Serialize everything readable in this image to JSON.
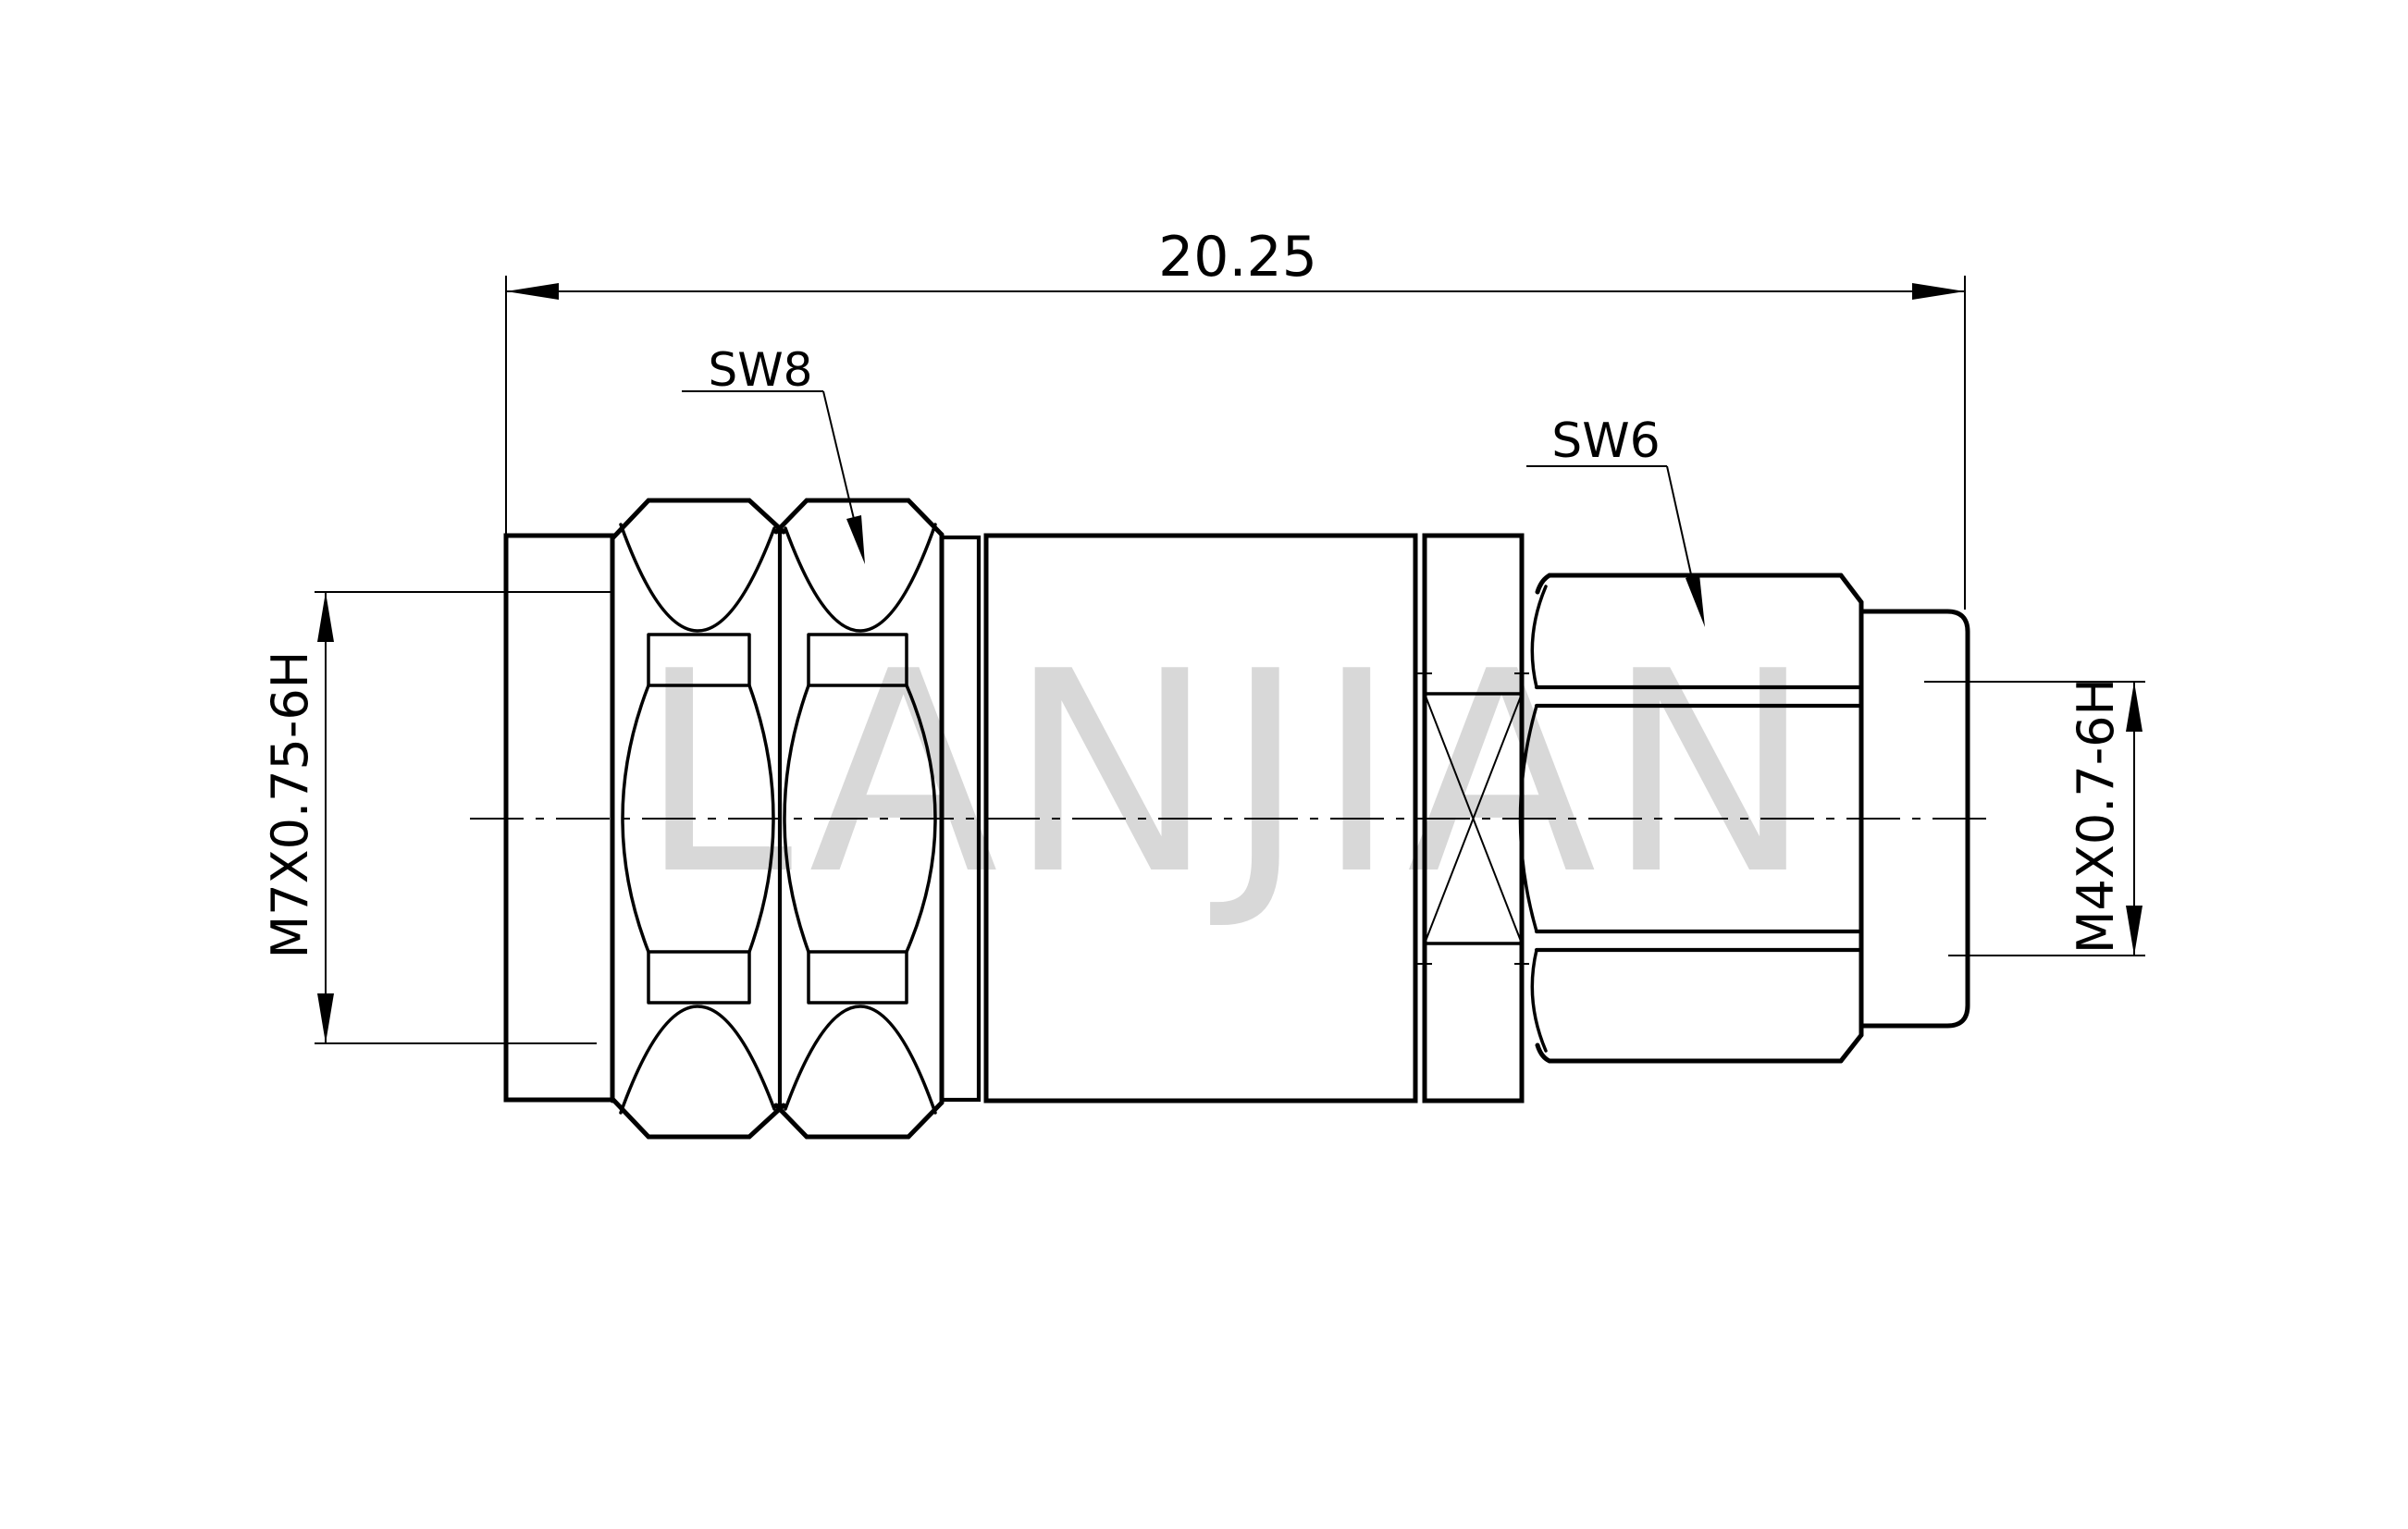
{
  "drawing": {
    "background": "#ffffff",
    "line_color": "#000000",
    "watermark": {
      "text": "LANJIAN",
      "color": "#d8d8d8"
    },
    "dimensions": {
      "overall_length": "20.25",
      "left_thread": "M7X0.75-6H",
      "right_thread": "M4X0.7-6H"
    },
    "labels": {
      "left_hex_wrench": "SW8",
      "right_hex_wrench": "SW6"
    }
  }
}
